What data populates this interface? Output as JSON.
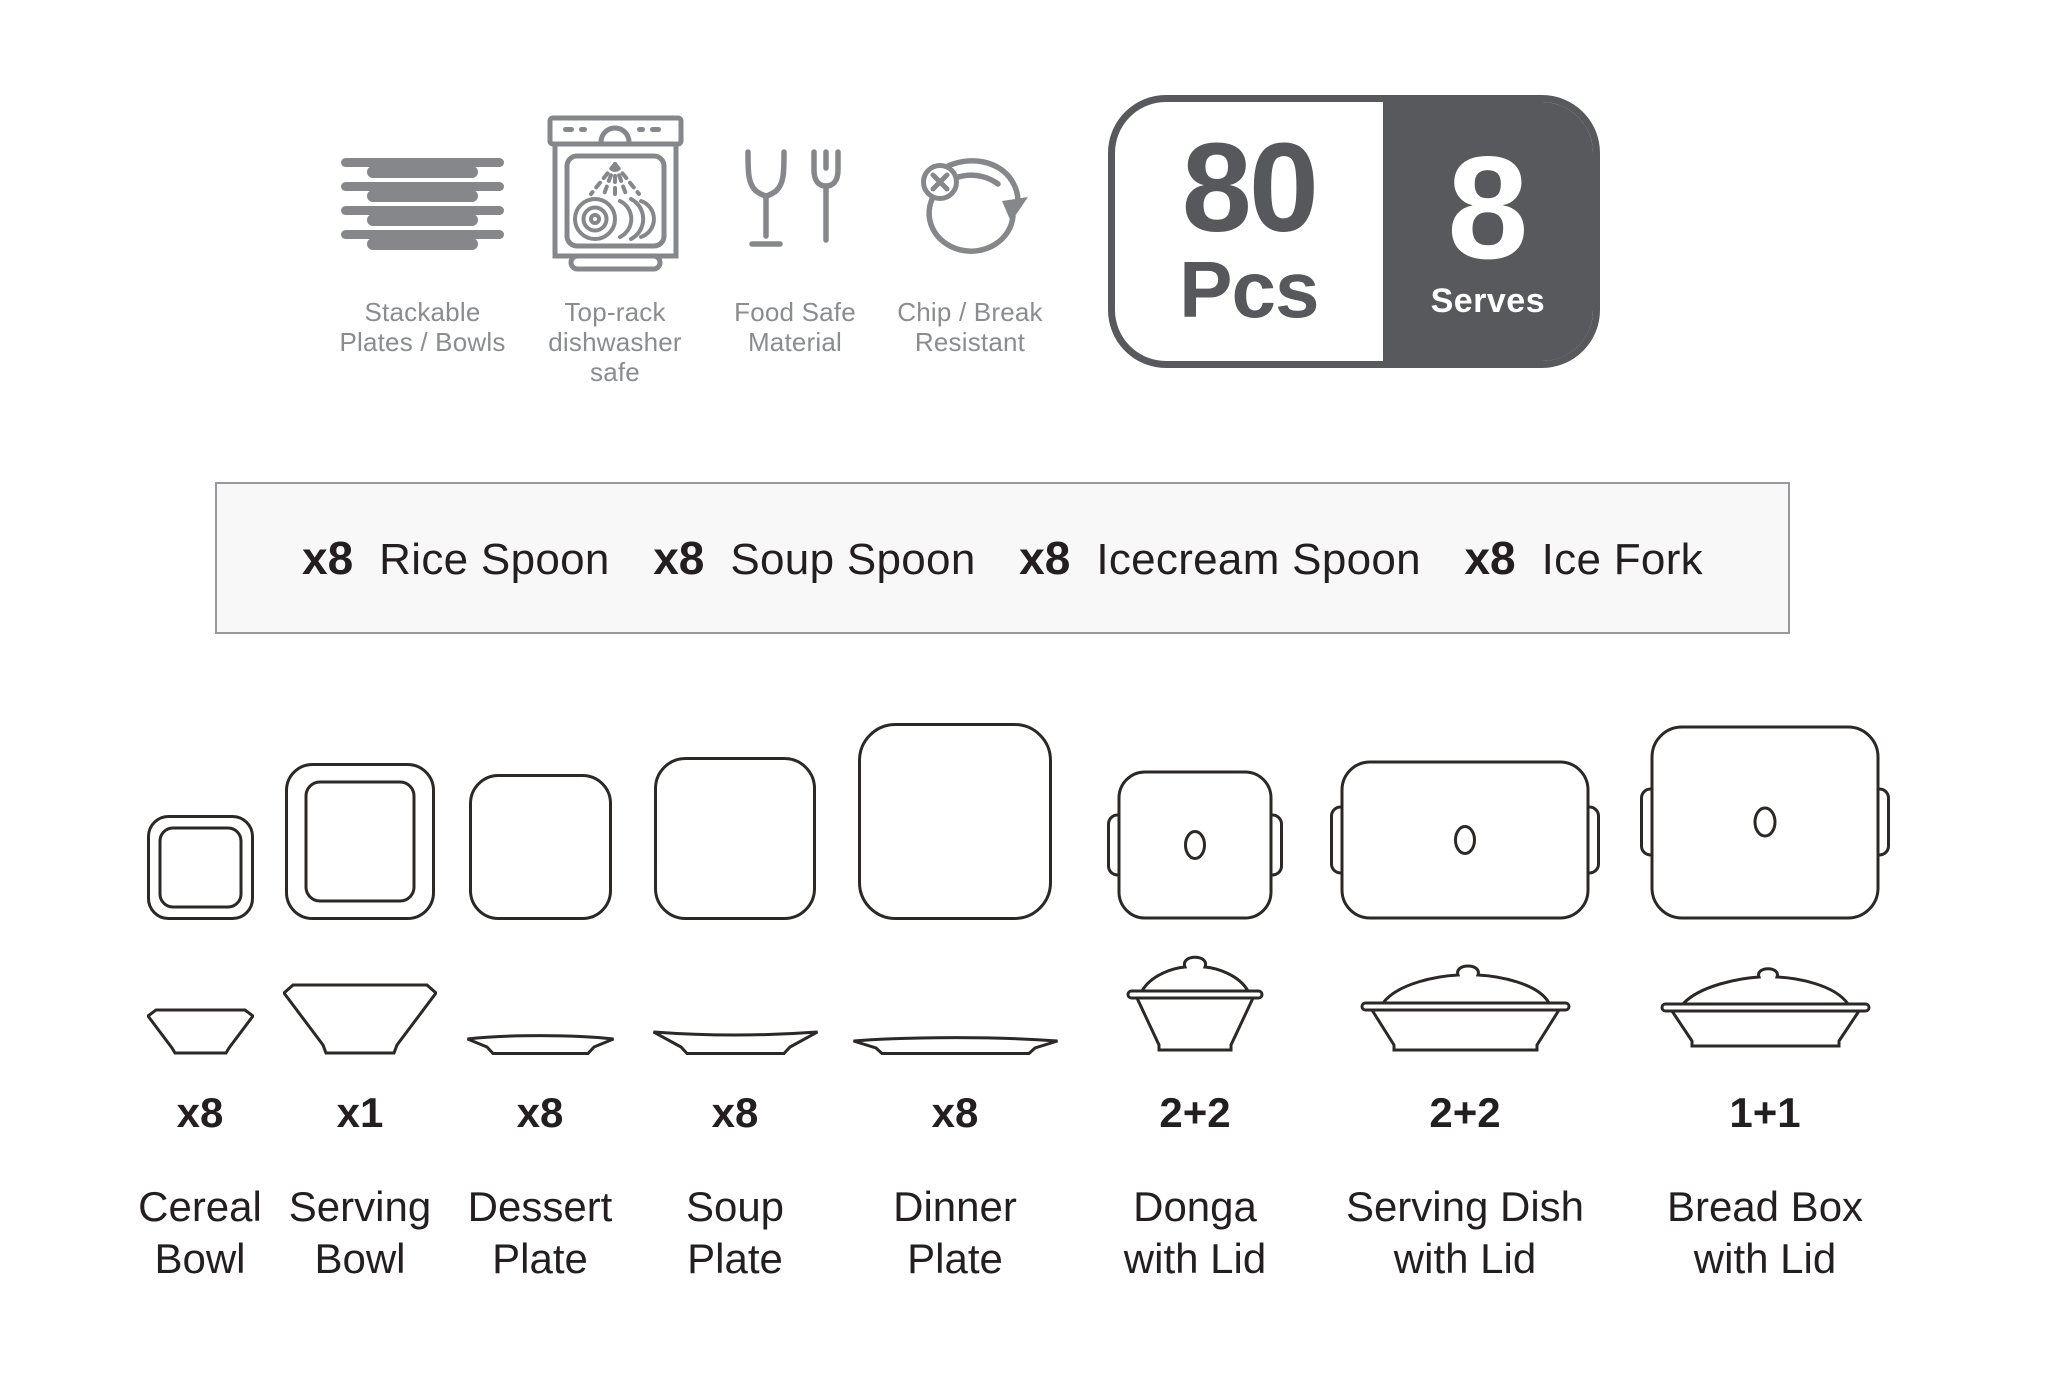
{
  "features": [
    {
      "icon": "stacked-plates-icon",
      "line1": "Stackable",
      "line2": "Plates / Bowls"
    },
    {
      "icon": "dishwasher-icon",
      "line1": "Top-rack",
      "line2": "dishwasher safe"
    },
    {
      "icon": "food-safe-icon",
      "line1": "Food Safe",
      "line2": "Material"
    },
    {
      "icon": "chip-break-icon",
      "line1": "Chip / Break",
      "line2": "Resistant"
    }
  ],
  "badge": {
    "pieces_value": "80",
    "pieces_label": "Pcs",
    "serves_value": "8",
    "serves_label": "Serves"
  },
  "cutlery": {
    "items": [
      {
        "qty": "x8",
        "name": "Rice Spoon"
      },
      {
        "qty": "x8",
        "name": "Soup Spoon"
      },
      {
        "qty": "x8",
        "name": "Icecream Spoon"
      },
      {
        "qty": "x8",
        "name": "Ice Fork"
      }
    ]
  },
  "products": [
    {
      "qty": "x8",
      "name_line1": "Cereal",
      "name_line2": "Bowl"
    },
    {
      "qty": "x1",
      "name_line1": "Serving",
      "name_line2": "Bowl"
    },
    {
      "qty": "x8",
      "name_line1": "Dessert",
      "name_line2": "Plate"
    },
    {
      "qty": "x8",
      "name_line1": "Soup",
      "name_line2": "Plate"
    },
    {
      "qty": "x8",
      "name_line1": "Dinner",
      "name_line2": "Plate"
    },
    {
      "qty": "2+2",
      "name_line1": "Donga",
      "name_line2": "with Lid"
    },
    {
      "qty": "2+2",
      "name_line1": "Serving Dish",
      "name_line2": "with Lid"
    },
    {
      "qty": "1+1",
      "name_line1": "Bread Box",
      "name_line2": "with Lid"
    }
  ],
  "colors": {
    "icon_gray": "#85878a",
    "label_gray": "#8a8c8e",
    "badge_dark": "#58595c",
    "text_dark": "#231f20",
    "dish_outline": "#2b2826",
    "strip_bg": "#f8f8f8",
    "strip_border": "#97999c"
  }
}
